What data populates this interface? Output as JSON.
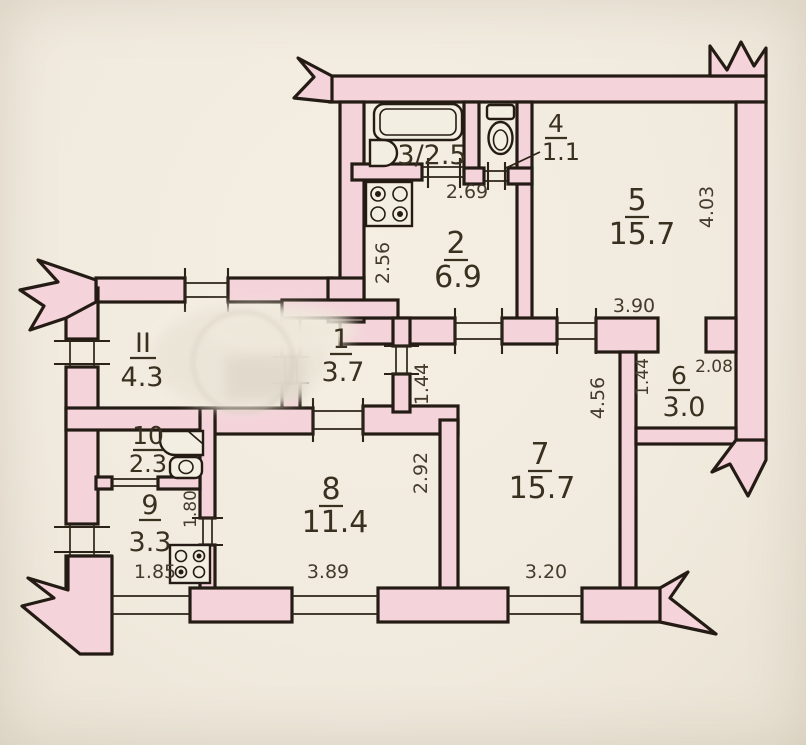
{
  "plan": {
    "title": "apartment floor plan (BTI technical drawing)",
    "colors": {
      "wall_fill": "#f4d4da",
      "wall_line": "#241c14",
      "paper": "#f1ebdf",
      "text": "#39301f"
    },
    "rooms": {
      "bath3": {
        "label": "3/2.5"
      },
      "wc4": {
        "number": "4",
        "area": "1.1"
      },
      "kitchen2": {
        "number": "2",
        "area": "6.9"
      },
      "room5": {
        "number": "5",
        "area": "15.7"
      },
      "hall1": {
        "number": "1",
        "area": "3.7"
      },
      "roomII": {
        "number": "II",
        "area": "4.3"
      },
      "store6": {
        "number": "6",
        "area": "3.0"
      },
      "room7": {
        "number": "7",
        "area": "15.7"
      },
      "room8": {
        "number": "8",
        "area": "11.4"
      },
      "kitchen9": {
        "number": "9",
        "area": "3.3"
      },
      "bath10": {
        "number": "10",
        "area": "2.3"
      }
    },
    "dimensions": {
      "d269": "2.69",
      "d256": "2.56",
      "d403": "4.03",
      "d390": "3.90",
      "d208": "2.08",
      "d144a": "1.44",
      "d144b": "1.44",
      "d456": "4.56",
      "d292": "2.92",
      "d389": "3.89",
      "d320": "3.20",
      "d185": "1.85",
      "d180": "1.80"
    }
  }
}
